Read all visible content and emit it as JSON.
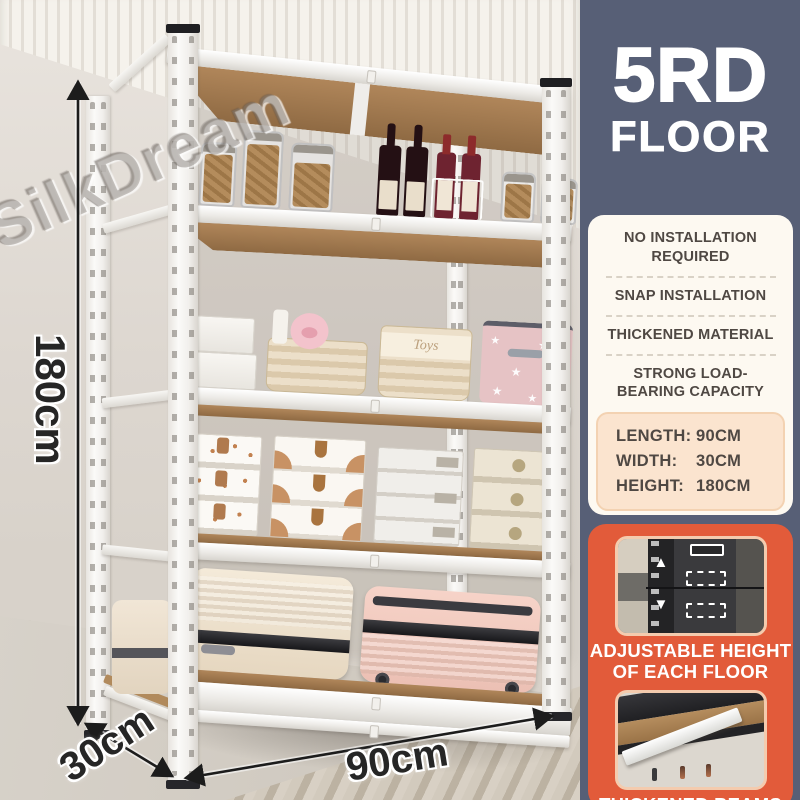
{
  "watermark": "SilkDream",
  "dimensions": {
    "height": "180cm",
    "depth": "30cm",
    "width": "90cm"
  },
  "badge": {
    "line1": "5RD",
    "line2": "FLOOR"
  },
  "features": [
    "NO INSTALLATION REQUIRED",
    "SNAP INSTALLATION",
    "THICKENED MATERIAL",
    "STRONG LOAD-BEARING CAPACITY"
  ],
  "specs": [
    {
      "label": "LENGTH:",
      "value": "90CM"
    },
    {
      "label": "WIDTH:",
      "value": "30CM"
    },
    {
      "label": "HEIGHT:",
      "value": "180CM"
    }
  ],
  "detail_cards": [
    {
      "caption_line1": "ADJUSTABLE HEIGHT",
      "caption_line2": "OF EACH FLOOR"
    },
    {
      "caption_line1": "THICKENED BEAMS",
      "caption_line2": ""
    }
  ],
  "shelf_items": {
    "toys_basket_label": "Toys"
  },
  "colors": {
    "sidebar_bg": "#575f76",
    "features_card_bg": "#fdf9f1",
    "specs_box_bg": "#fbe4cf",
    "accent_orange": "#e25b3a",
    "text_dark": "#4f4843",
    "shelf_white": "#f6f5f3",
    "wood": "#a87f50"
  }
}
